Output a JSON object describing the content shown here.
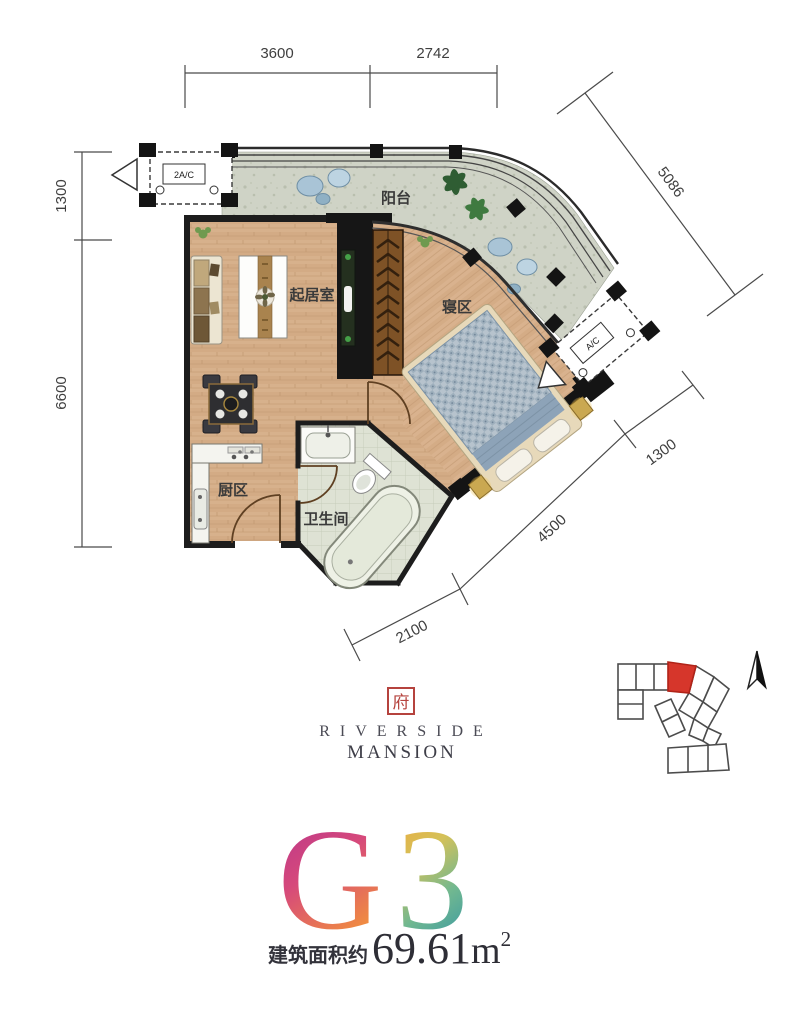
{
  "plan": {
    "labels": {
      "balcony": "阳台",
      "living_room": "起居室",
      "sleeping_area": "寝区",
      "kitchen": "厨区",
      "bathroom": "卫生间"
    },
    "equipment": {
      "ac_top_left": "2A/C",
      "ac_right": "A/C"
    },
    "dimensions": {
      "top": [
        "3600",
        "2742"
      ],
      "left": [
        "1300",
        "6600"
      ],
      "right_diagonal": "5086",
      "bottom_diagonal": [
        "2100",
        "4500",
        "1300"
      ]
    }
  },
  "branding": {
    "seal_character": "府",
    "brand_line1": "RIVERSIDE",
    "brand_line2": "MANSION"
  },
  "unit": {
    "model_letter": "G",
    "model_number": "3",
    "area_prefix": "建筑面积约",
    "area_value": "69.61",
    "area_unit": "m",
    "area_exponent": "2"
  },
  "colors": {
    "unit_highlight": "#d6362b",
    "seal_red": "#b5433e",
    "wall": "#161616",
    "wood_floor": "#d7b18c",
    "balcony_stone": "#cfd3c6",
    "bathroom_tile": "#dee2d4",
    "bed_quilt": "#b7c3cd",
    "g_gradient_top": "#b23190",
    "g_gradient_bottom": "#f2913c",
    "three_gradient_top": "#efa83c",
    "three_gradient_bottom": "#3c9aa2"
  }
}
